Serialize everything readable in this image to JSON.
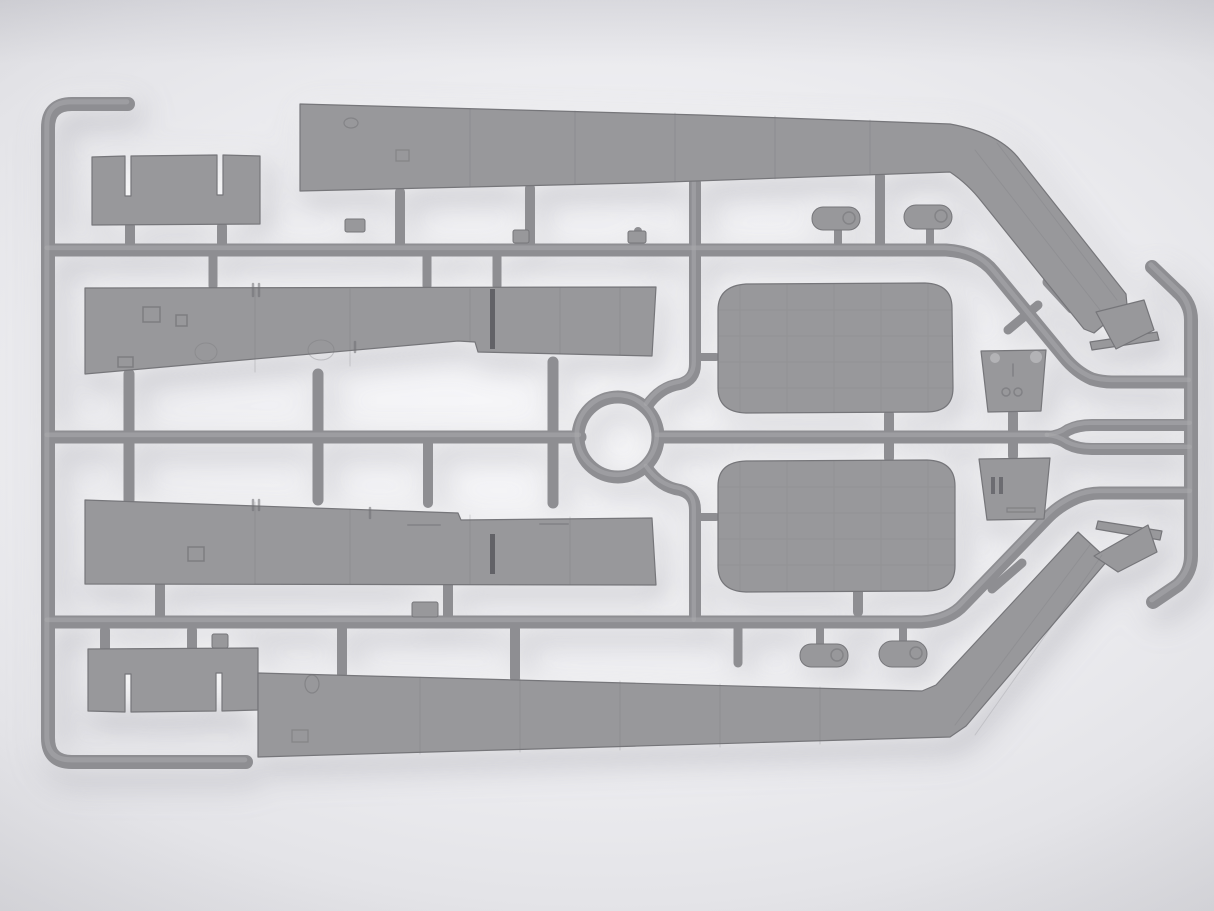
{
  "scene": {
    "type": "photograph",
    "subject": "gray injection-molded plastic model kit sprue with aircraft wing panels, flaps, nacelle halves, bulkheads and wingtip parts",
    "canvas": {
      "w": 1214,
      "h": 911
    },
    "palette": {
      "bg_center": "#f8f8fa",
      "bg_edge": "#cdcdd2",
      "plastic": "#98989b",
      "plastic_edge": "#76767a",
      "runner": "#8e8e92",
      "runner_hi": "#a9a9ad",
      "slit": "#55555a",
      "detail": "#6f6f73",
      "detail_light": "#b6b6b9"
    }
  },
  "sprue": {
    "runners": [
      {
        "name": "left-rail",
        "d": "M 128 104 L 72 104 Q 48 104 48 128 L 48 738 Q 48 762 72 762 L 246 762",
        "w": 14
      },
      {
        "name": "top-runner",
        "d": "M 48 250 L 946 250 Q 978 252 994 272 L 1064 357 Q 1076 372 1092 379 Q 1102 382 1112 382 L 1190 382",
        "w": 13
      },
      {
        "name": "right-rail",
        "d": "M 1152 267 L 1177 291 Q 1191 303 1191 320 L 1191 556 Q 1191 573 1178 585 L 1153 602",
        "w": 14
      },
      {
        "name": "mid-runner-left",
        "d": "M 48 437 L 580 437",
        "w": 13
      },
      {
        "name": "center-ring",
        "d": "M 578 437 a 40 40 0 1 0 80 0 a 40 40 0 1 0 -80 0",
        "w": 13
      },
      {
        "name": "mid-runner-right",
        "d": "M 658 437 L 1048 437",
        "w": 13
      },
      {
        "name": "mid-branch-upper",
        "d": "M 1048 437 Q 1060 436 1068 430 Q 1078 425 1092 425 L 1191 425",
        "w": 12
      },
      {
        "name": "mid-branch-lower",
        "d": "M 1048 437 Q 1060 438 1068 444 Q 1078 449 1092 449 L 1191 449",
        "w": 12
      },
      {
        "name": "s-curve-top",
        "d": "M 695 183 L 695 364 Q 695 380 680 384 Q 660 387 647 406",
        "w": 12
      },
      {
        "name": "s-curve-bottom",
        "d": "M 647 468 Q 660 487 680 490 Q 695 494 695 510 L 695 622",
        "w": 12
      },
      {
        "name": "lower-runner",
        "d": "M 48 622 L 922 622 Q 950 620 964 604 L 1046 519 Q 1058 506 1076 498 Q 1088 493 1100 493 L 1191 493",
        "w": 13
      }
    ],
    "gates": [
      {
        "name": "gate-wing-top",
        "d": "M 400 192 L 400 247",
        "w": 10
      },
      {
        "name": "gate-wing-top",
        "d": "M 530 188 L 530 247",
        "w": 10
      },
      {
        "name": "gate-wing-top",
        "d": "M 880 176 L 880 247",
        "w": 10
      },
      {
        "name": "gate-fairing",
        "d": "M 838 228 L 838 246",
        "w": 8
      },
      {
        "name": "gate-fairing",
        "d": "M 930 224 L 930 246",
        "w": 8
      },
      {
        "name": "gate-flap",
        "d": "M 130 226 L 130 249",
        "w": 10
      },
      {
        "name": "gate-flap",
        "d": "M 222 226 L 222 249",
        "w": 10
      },
      {
        "name": "gate-mid-wing",
        "d": "M 213 252 L 213 286",
        "w": 9
      },
      {
        "name": "gate-mid-wing",
        "d": "M 427 252 L 427 286",
        "w": 9
      },
      {
        "name": "gate-mid-wing",
        "d": "M 497 252 L 497 286",
        "w": 9
      },
      {
        "name": "gate-stub",
        "d": "M 638 231 L 638 249",
        "w": 8
      },
      {
        "name": "gate-bar",
        "d": "M 129 374 L 129 500",
        "w": 11
      },
      {
        "name": "gate-bar",
        "d": "M 318 374 L 318 500",
        "w": 11
      },
      {
        "name": "gate-bar",
        "d": "M 553 362 L 553 503",
        "w": 11
      },
      {
        "name": "gate-bar",
        "d": "M 428 440 L 428 503",
        "w": 10
      },
      {
        "name": "gate-nacelle",
        "d": "M 889 414 L 889 458",
        "w": 10
      },
      {
        "name": "gate-bulkhead",
        "d": "M 1013 413 L 1013 456",
        "w": 10
      },
      {
        "name": "gate-stub",
        "d": "M 695 357 L 716 357",
        "w": 8
      },
      {
        "name": "gate-stub",
        "d": "M 695 517 L 716 517",
        "w": 8
      },
      {
        "name": "gate-flap",
        "d": "M 105 630 L 105 648",
        "w": 10
      },
      {
        "name": "gate-flap",
        "d": "M 192 630 L 192 648",
        "w": 10
      },
      {
        "name": "gate-wing-bottom",
        "d": "M 342 629 L 342 674",
        "w": 10
      },
      {
        "name": "gate-wing-bottom",
        "d": "M 515 629 L 515 678",
        "w": 10
      },
      {
        "name": "gate-stub",
        "d": "M 738 629 L 738 663",
        "w": 9
      },
      {
        "name": "gate-fairing",
        "d": "M 820 629 L 820 645",
        "w": 8
      },
      {
        "name": "gate-fairing",
        "d": "M 903 629 L 903 642",
        "w": 8
      },
      {
        "name": "gate-bar",
        "d": "M 160 584 L 160 618",
        "w": 10
      },
      {
        "name": "gate-bar",
        "d": "M 448 584 L 448 618",
        "w": 10
      },
      {
        "name": "gate-bar",
        "d": "M 858 591 L 858 612",
        "w": 10
      },
      {
        "name": "cross-stub",
        "d": "M 1008 330 L 1038 305",
        "w": 9
      },
      {
        "name": "cap-stub",
        "d": "M 1048 282 L 1072 308",
        "w": 11
      },
      {
        "name": "cross-stub",
        "d": "M 992 589 L 1022 563",
        "w": 9
      },
      {
        "name": "cap-stub",
        "d": "M 1053 589 L 1076 565",
        "w": 11
      }
    ],
    "blocks": [
      {
        "name": "molding-block",
        "x": 345,
        "y": 219,
        "w": 20,
        "h": 13,
        "rx": 2
      },
      {
        "name": "molding-block",
        "x": 513,
        "y": 230,
        "w": 16,
        "h": 13,
        "rx": 2
      },
      {
        "name": "molding-block",
        "x": 628,
        "y": 231,
        "w": 18,
        "h": 12,
        "rx": 2
      },
      {
        "name": "molding-block",
        "x": 412,
        "y": 602,
        "w": 26,
        "h": 15,
        "rx": 2
      },
      {
        "name": "molding-block",
        "x": 212,
        "y": 634,
        "w": 16,
        "h": 14,
        "rx": 2
      },
      {
        "name": "small-fairing-part",
        "x": 812,
        "y": 207,
        "w": 48,
        "h": 23,
        "rx": 11
      },
      {
        "name": "small-fairing-part",
        "x": 904,
        "y": 205,
        "w": 48,
        "h": 24,
        "rx": 12
      },
      {
        "name": "small-fairing-part",
        "x": 800,
        "y": 644,
        "w": 48,
        "h": 23,
        "rx": 11
      },
      {
        "name": "small-fairing-part",
        "x": 879,
        "y": 641,
        "w": 48,
        "h": 26,
        "rx": 13
      }
    ],
    "parts": [
      {
        "name": "flap-part-top-left",
        "d": "M 92 157 L 125 156 L 125 196 L 131 196 L 131 156 L 217 155 L 217 195 L 223 195 L 223 155 L 260 156 L 260 224 L 92 225 Z"
      },
      {
        "name": "wing-panel-top",
        "d": "M 300 104 L 700 115 L 950 124 Q 1000 133 1020 160 L 1126 294 L 1127 305 L 1094 333 L 1084 329 L 982 202 Q 968 184 950 172 L 640 183 L 300 191 Z"
      },
      {
        "name": "wingtip-plate-top",
        "d": "M 1090 342 L 1157 332 L 1159 340 L 1092 350 Z"
      },
      {
        "name": "wingtip-part-top",
        "d": "M 1096 312 L 1144 300 L 1154 330 L 1116 349 Z"
      },
      {
        "name": "wing-panel-middle-upper",
        "d": "M 85 288 L 656 287 L 652 356 L 478 352 L 475 342 L 458 341 L 85 374 Z"
      },
      {
        "name": "wing-panel-middle-lower",
        "d": "M 85 500 L 458 513 L 461 520 L 652 518 L 656 585 L 85 584 Z"
      },
      {
        "name": "nacelle-half-upper",
        "d": "M 718 310 Q 718 286 746 284 L 925 283 Q 952 284 952 308 L 953 388 Q 953 412 926 412 L 746 413 Q 718 412 718 388 Z"
      },
      {
        "name": "nacelle-half-lower",
        "d": "M 718 486 Q 718 462 746 461 L 927 460 Q 955 461 955 486 L 955 566 Q 955 590 928 591 L 746 592 Q 718 591 718 566 Z"
      },
      {
        "name": "bulkhead-upper",
        "d": "M 981 351 L 1046 350 L 1041 411 L 988 412 Z"
      },
      {
        "name": "bulkhead-lower",
        "d": "M 979 459 L 1050 458 L 1044 519 L 987 520 Z"
      },
      {
        "name": "flap-part-bottom-left",
        "d": "M 88 649 L 258 648 L 258 710 L 222 711 L 222 673 L 216 673 L 216 711 L 131 712 L 131 674 L 125 674 L 125 712 L 88 711 Z"
      },
      {
        "name": "wing-panel-bottom",
        "d": "M 258 673 L 922 691 L 936 685 L 1078 532 L 1108 560 L 966 726 L 950 737 L 258 757 Z"
      },
      {
        "name": "wingtip-plate-bottom",
        "d": "M 1098 521 L 1162 531 L 1160 540 L 1096 529 Z"
      },
      {
        "name": "wingtip-part-bottom",
        "d": "M 1094 556 L 1148 525 L 1157 552 L 1118 572 Z"
      }
    ],
    "details": [
      {
        "name": "mold-slit",
        "d": "M 490 289 h 5 v 60 h -5 Z",
        "fill": "slit",
        "op": 0.8
      },
      {
        "name": "mold-slit",
        "d": "M 490 534 h 5 v 40 h -5 Z",
        "fill": "slit",
        "op": 0.8
      },
      {
        "name": "panel-lines",
        "d": "M 470 109 V 186 M 575 111 V 184 M 675 113 V 181 M 775 116 V 179 M 870 120 V 174",
        "stroke": "detail",
        "w": 1,
        "op": 0.28
      },
      {
        "name": "panel-lines",
        "d": "M 255 289 V 372 M 350 289 V 366 M 470 289 V 342 M 560 288 V 354 M 620 288 V 355",
        "stroke": "detail",
        "w": 1,
        "op": 0.25
      },
      {
        "name": "panel-lines",
        "d": "M 255 502 V 584 M 350 509 V 584 M 470 515 V 584 M 570 517 V 584",
        "stroke": "detail",
        "w": 1,
        "op": 0.25
      },
      {
        "name": "panel-lines",
        "d": "M 420 677 V 754 M 520 679 V 752 M 620 681 V 750 M 720 684 V 747 M 820 687 V 744",
        "stroke": "detail",
        "w": 1,
        "op": 0.25
      },
      {
        "name": "rib-lines",
        "d": "M 975 150 L 1100 310 M 997 143 L 1117 300",
        "stroke": "detail",
        "w": 1,
        "op": 0.2
      },
      {
        "name": "rib-lines",
        "d": "M 955 725 L 1090 545 M 975 735 L 1102 555",
        "stroke": "detail",
        "w": 1,
        "op": 0.2
      },
      {
        "name": "hatch-details",
        "d": "M 143 307 h 17 v 15 h -17 Z M 176 315 h 11 v 11 h -11 Z M 118 357 h 15 v 10 h -15 Z",
        "stroke": "detail",
        "w": 1.5,
        "op": 0.65
      },
      {
        "name": "circle-details",
        "d": "M 195 352 a 11 9 0 1 0 22 0 a 11 9 0 1 0 -22 0 M 308 350 a 13 10 0 1 0 26 0 a 13 10 0 1 0 -26 0",
        "stroke": "detail",
        "w": 1,
        "op": 0.3
      },
      {
        "name": "hatch-details",
        "d": "M 188 547 h 16 v 14 h -16 Z",
        "stroke": "detail",
        "w": 1.5,
        "op": 0.65
      },
      {
        "name": "tick-details",
        "d": "M 253 284 v 12 M 259 284 v 12 M 355 342 v 10 M 253 500 v 10 M 259 500 v 10 M 370 508 v 10",
        "stroke": "detail",
        "w": 2.5,
        "op": 0.55
      },
      {
        "name": "dash-details",
        "d": "M 408 525 h 32 M 540 524 h 28",
        "stroke": "detail",
        "w": 2,
        "op": 0.4
      },
      {
        "name": "small-marks",
        "d": "M 344 123 a 7 5 0 1 0 14 0 a 7 5 0 1 0 -14 0 M 396 150 h 13 v 11 h -13 Z",
        "stroke": "detail",
        "w": 1.2,
        "op": 0.5
      },
      {
        "name": "small-marks",
        "d": "M 305 684 a 7 9 0 1 0 14 0 a 7 9 0 1 0 -14 0 M 292 730 h 16 v 12 h -16 Z",
        "stroke": "detail",
        "w": 1.2,
        "op": 0.5
      },
      {
        "name": "surface-grid",
        "d": "M 740 286 V 411 M 787 285 V 412 M 834 284 V 412 M 881 284 V 412 M 928 284 V 411 M 719 310 H 952 M 718 336 H 953 M 718 362 H 953 M 718 388 H 953",
        "stroke": "detail",
        "w": 1,
        "op": 0.14
      },
      {
        "name": "surface-grid",
        "d": "M 740 463 V 590 M 787 462 V 591 M 834 461 V 591 M 881 461 V 591 M 928 461 V 590 M 719 487 H 954 M 718 513 H 955 M 718 539 H 955 M 718 565 H 954",
        "stroke": "detail",
        "w": 1,
        "op": 0.14
      },
      {
        "name": "bulkhead-dots",
        "d": "M 990 358 a 5 5 0 1 0 10 0 a 5 5 0 1 0 -10 0 M 1030 357 a 6 6 0 1 0 12 0 a 6 6 0 1 0 -12 0",
        "fill": "detail_light",
        "op": 0.9
      },
      {
        "name": "bulkhead-marks",
        "d": "M 1013 364 v 12 M 1002 392 a 4 4 0 1 0 8 0 a 4 4 0 1 0 -8 0 M 1014 392 a 4 4 0 1 0 8 0 a 4 4 0 1 0 -8 0",
        "stroke": "detail",
        "w": 1.5,
        "op": 0.55
      },
      {
        "name": "bulkhead-slots",
        "d": "M 991 477 h 4 v 17 h -4 Z M 999 477 h 4 v 17 h -4 Z",
        "fill": "slit",
        "op": 0.65
      },
      {
        "name": "bulkhead-slot",
        "d": "M 1007 508 h 28 v 4 h -28 Z",
        "stroke": "detail",
        "w": 1.2,
        "op": 0.55
      },
      {
        "name": "fairing-rings",
        "d": "M 843 218 a 6 6 0 1 0 12 0 a 6 6 0 1 0 -12 0 M 935 216 a 6 6 0 1 0 12 0 a 6 6 0 1 0 -12 0 M 831 655 a 6 6 0 1 0 12 0 a 6 6 0 1 0 -12 0 M 910 653 a 6 6 0 1 0 12 0 a 6 6 0 1 0 -12 0",
        "stroke": "detail",
        "w": 1.5,
        "op": 0.5
      }
    ]
  }
}
